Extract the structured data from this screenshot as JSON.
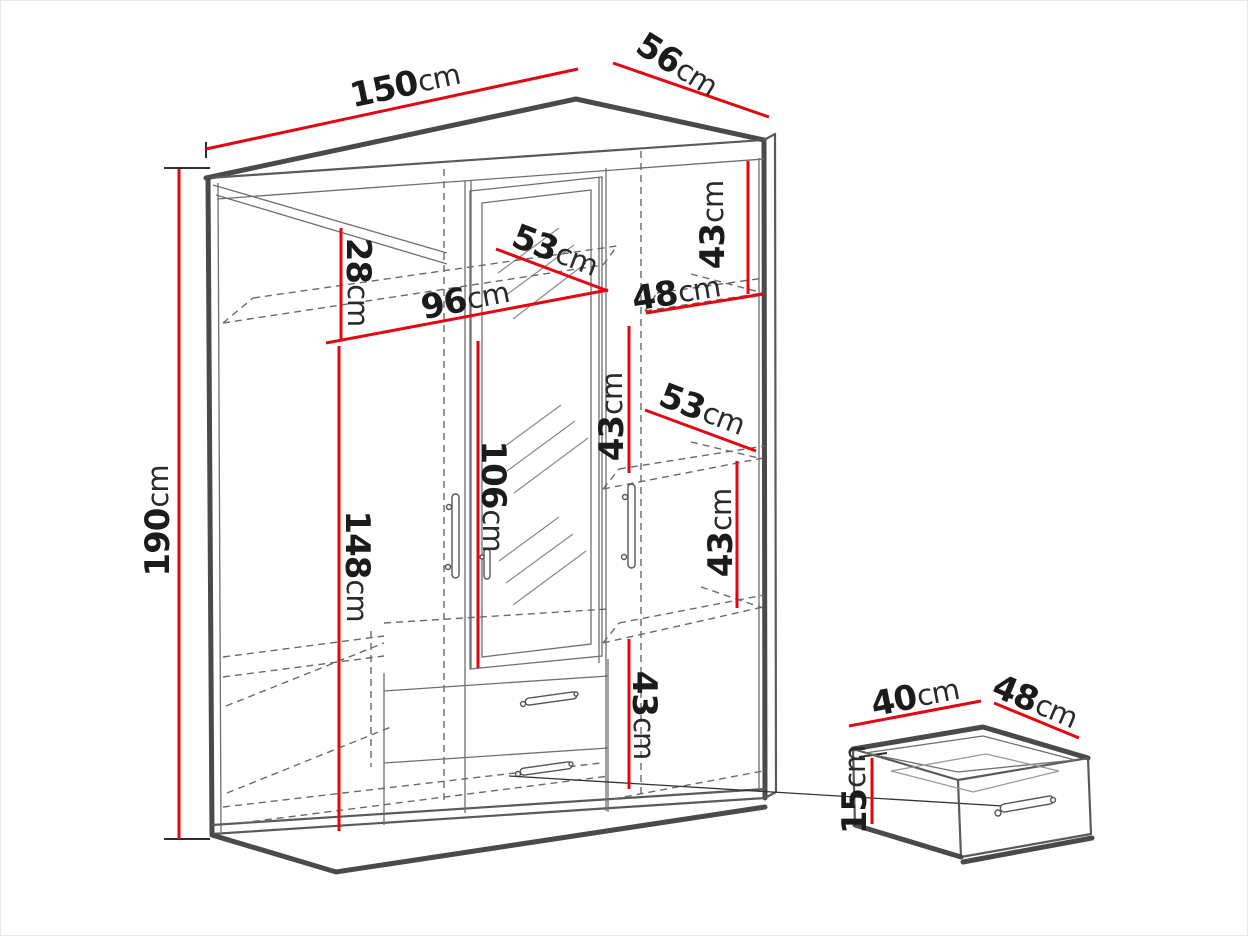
{
  "diagram": {
    "unit": "cm",
    "colors": {
      "dimension_accent": "#e30613",
      "text": "#1b1b1b",
      "structure": "#4a4a4a"
    }
  },
  "wardrobe": {
    "dimensions": [
      {
        "name": "overall-width",
        "value": "150",
        "unit": "cm",
        "line": [
          205,
          148,
          577,
          68
        ],
        "label": [
          404,
          84
        ],
        "angle": -12
      },
      {
        "name": "overall-depth",
        "value": "56",
        "unit": "cm",
        "line": [
          612,
          62,
          768,
          116
        ],
        "label": [
          676,
          64
        ],
        "angle": 32
      },
      {
        "name": "overall-height",
        "value": "190",
        "unit": "cm",
        "line": [
          178,
          168,
          178,
          838
        ],
        "label": [
          157,
          520
        ],
        "angle": -90
      },
      {
        "name": "top-compartment-height",
        "value": "28",
        "unit": "cm",
        "line": [
          340,
          227,
          340,
          338
        ],
        "label": [
          357,
          281
        ],
        "angle": 90
      },
      {
        "name": "left-section-width",
        "value": "96",
        "unit": "cm",
        "line": [
          325,
          342,
          607,
          289
        ],
        "label": [
          464,
          299
        ],
        "angle": -11
      },
      {
        "name": "top-shelf-width",
        "value": "53",
        "unit": "cm",
        "line": [
          495,
          248,
          607,
          290
        ],
        "label": [
          554,
          250
        ],
        "angle": 21
      },
      {
        "name": "right-section-width",
        "value": "48",
        "unit": "cm",
        "line": [
          645,
          312,
          763,
          293
        ],
        "label": [
          675,
          292
        ],
        "angle": -9
      },
      {
        "name": "right-top-shelf-height",
        "value": "43",
        "unit": "cm",
        "line": [
          747,
          160,
          747,
          293
        ],
        "label": [
          712,
          224
        ],
        "angle": -90
      },
      {
        "name": "shelf-spacing-upper",
        "value": "43",
        "unit": "cm",
        "line": [
          628,
          325,
          628,
          472
        ],
        "label": [
          611,
          416
        ],
        "angle": -90
      },
      {
        "name": "middle-shelf-width",
        "value": "53",
        "unit": "cm",
        "line": [
          644,
          409,
          755,
          450
        ],
        "label": [
          701,
          409
        ],
        "angle": 21
      },
      {
        "name": "shelf-spacing-middle",
        "value": "43",
        "unit": "cm",
        "line": [
          736,
          460,
          736,
          607
        ],
        "label": [
          720,
          532
        ],
        "angle": -90
      },
      {
        "name": "mirror-door-height",
        "value": "106",
        "unit": "cm",
        "line": [
          477,
          340,
          477,
          667
        ],
        "label": [
          492,
          495
        ],
        "angle": 90
      },
      {
        "name": "lower-interior-height",
        "value": "148",
        "unit": "cm",
        "line": [
          338,
          345,
          338,
          830
        ],
        "label": [
          356,
          565
        ],
        "angle": 90
      },
      {
        "name": "shelf-spacing-lower",
        "value": "43",
        "unit": "cm",
        "line": [
          628,
          638,
          628,
          788
        ],
        "label": [
          643,
          714
        ],
        "angle": 90
      }
    ]
  },
  "drawer_detail": {
    "dimensions": [
      {
        "name": "drawer-width",
        "value": "40",
        "unit": "cm",
        "line": [
          848,
          725,
          980,
          700
        ],
        "label": [
          914,
          696
        ],
        "angle": -11
      },
      {
        "name": "drawer-depth",
        "value": "48",
        "unit": "cm",
        "line": [
          993,
          702,
          1078,
          737
        ],
        "label": [
          1034,
          701
        ],
        "angle": 23
      },
      {
        "name": "drawer-height",
        "value": "15",
        "unit": "cm",
        "line": [
          871,
          757,
          871,
          823
        ],
        "label": [
          854,
          789
        ],
        "angle": -90
      }
    ]
  }
}
